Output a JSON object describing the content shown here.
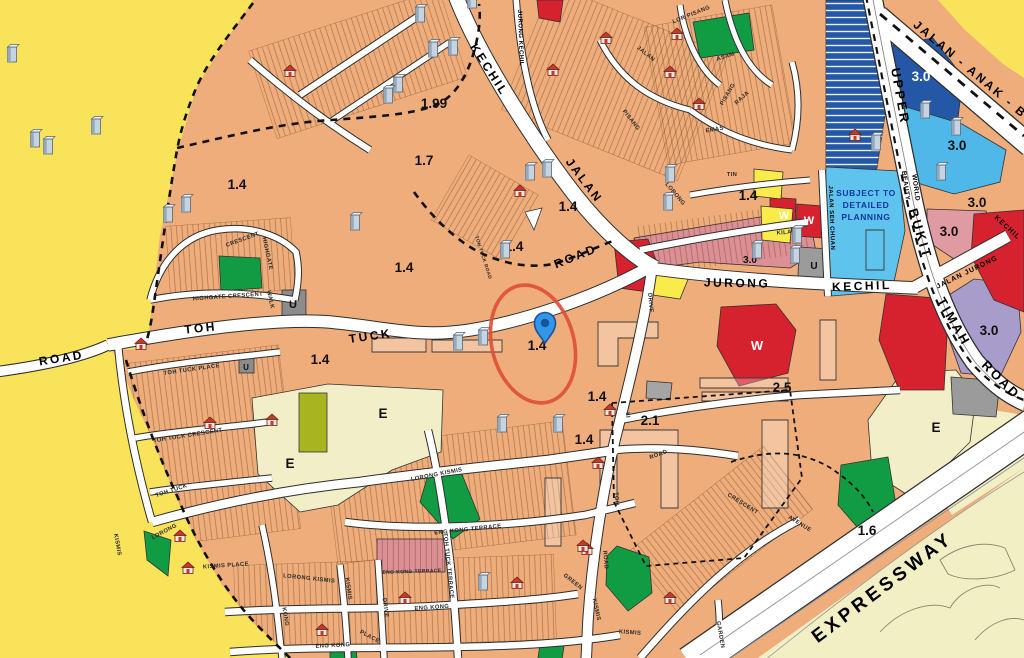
{
  "map": {
    "title": "Master Plan zoning map - Toh Tuck / Jalan Jurong Kechil area",
    "colors": {
      "outside_yellow": "#F8E35A",
      "residential_tan": "#EFAD7B",
      "road_white": "#FFFFFF",
      "civic_cream": "#F1EEC8",
      "olive": "#A9B421",
      "park_green": "#119C44",
      "dark_blue": "#2458A6",
      "light_blue": "#4FB8E8",
      "planning_blue": "#5EC4EE",
      "planning_text": "#14339E",
      "purple": "#A89CCA",
      "commercial_red": "#D6212E",
      "pink": "#E09AA2",
      "yellow_zone": "#F9EC4A",
      "gray_zone": "#9B9B9B",
      "pin_blue": "#3596E8",
      "highlight_red": "#E04F35"
    },
    "subject_planning": {
      "lines": [
        "SUBJECT TO",
        "DETAILED",
        "PLANNING"
      ],
      "x": 866,
      "y": 196,
      "lh": 12
    },
    "region_labels": [
      {
        "t": "1.99",
        "x": 434,
        "y": 108
      },
      {
        "t": "1.7",
        "x": 424,
        "y": 165
      },
      {
        "t": "1.4",
        "x": 237,
        "y": 189
      },
      {
        "t": "1.4",
        "x": 404,
        "y": 272
      },
      {
        "t": "1.4",
        "x": 568,
        "y": 211
      },
      {
        "t": "1.4",
        "x": 514,
        "y": 251
      },
      {
        "t": "1.4",
        "x": 748,
        "y": 200
      },
      {
        "t": "1.4",
        "x": 320,
        "y": 364
      },
      {
        "t": "1.4",
        "x": 537,
        "y": 350
      },
      {
        "t": "1.4",
        "x": 597,
        "y": 401
      },
      {
        "t": "1.4",
        "x": 584,
        "y": 444
      },
      {
        "t": "2.1",
        "x": 650,
        "y": 425
      },
      {
        "t": "2.5",
        "x": 782,
        "y": 392
      },
      {
        "t": "1.6",
        "x": 867,
        "y": 535
      },
      {
        "t": "3.0",
        "x": 921,
        "y": 81,
        "c": "#FFFFFF"
      },
      {
        "t": "3.0",
        "x": 957,
        "y": 150
      },
      {
        "t": "3.0",
        "x": 977,
        "y": 207
      },
      {
        "t": "3.0",
        "x": 949,
        "y": 236
      },
      {
        "t": "3.0",
        "x": 989,
        "y": 335
      },
      {
        "t": "3.0",
        "x": 750,
        "y": 263,
        "s": 10
      },
      {
        "t": "W",
        "x": 784,
        "y": 219,
        "c": "#FFFFFF",
        "s": 11
      },
      {
        "t": "W",
        "x": 809,
        "y": 224,
        "c": "#FFFFFF",
        "s": 11
      },
      {
        "t": "W",
        "x": 757,
        "y": 350,
        "c": "#FFFFFF",
        "s": 13
      },
      {
        "t": "E",
        "x": 383,
        "y": 418
      },
      {
        "t": "E",
        "x": 290,
        "y": 468
      },
      {
        "t": "E",
        "x": 936,
        "y": 432
      },
      {
        "t": "U",
        "x": 293,
        "y": 308,
        "s": 11
      },
      {
        "t": "U",
        "x": 814,
        "y": 269,
        "s": 10
      },
      {
        "t": "U",
        "x": 246,
        "y": 370,
        "s": 8
      }
    ],
    "road_labels": [
      {
        "t": "KECHIL",
        "x": 486,
        "y": 72,
        "r": 57
      },
      {
        "t": "JALAN",
        "x": 581,
        "y": 183,
        "r": 53
      },
      {
        "t": "ROAD",
        "x": 577,
        "y": 260,
        "r": -22
      },
      {
        "t": "TOH",
        "x": 201,
        "y": 332,
        "r": -6
      },
      {
        "t": "TUCK",
        "x": 371,
        "y": 340,
        "r": -8
      },
      {
        "t": "ROAD",
        "x": 62,
        "y": 362,
        "r": -9
      },
      {
        "t": "JURONG",
        "x": 737,
        "y": 287,
        "r": 1
      },
      {
        "t": "KECHIL",
        "x": 862,
        "y": 290,
        "r": -2
      },
      {
        "t": "UPPER",
        "x": 896,
        "y": 97,
        "r": 80,
        "s": 13
      },
      {
        "t": "BUKIT",
        "x": 916,
        "y": 235,
        "r": 73,
        "s": 13
      },
      {
        "t": "TIMAH",
        "x": 950,
        "y": 324,
        "r": 60,
        "s": 13
      },
      {
        "t": "ROAD",
        "x": 998,
        "y": 383,
        "r": 45,
        "s": 13
      },
      {
        "t": "JALAN - ANAK - BU",
        "x": 972,
        "y": 76,
        "r": 40,
        "s": 12
      },
      {
        "t": "EXPRESSWAY",
        "x": 886,
        "y": 592,
        "r": -37,
        "s": 19,
        "ls": 4
      },
      {
        "t": "JALAN JURONG",
        "x": 968,
        "y": 274,
        "r": -26,
        "s": 7,
        "ls": 1
      },
      {
        "t": "KECHIL",
        "x": 1006,
        "y": 229,
        "r": 42,
        "s": 7,
        "ls": 1
      },
      {
        "t": "BEAUTY",
        "x": 904,
        "y": 186,
        "r": 82,
        "s": 6.5,
        "ls": 0.5
      },
      {
        "t": "WORLD",
        "x": 914,
        "y": 188,
        "r": 82,
        "s": 6.5,
        "ls": 0.5
      },
      {
        "t": "JURONG KECHIL",
        "x": 519,
        "y": 38,
        "r": 88,
        "s": 6,
        "ls": 0.5
      },
      {
        "t": "JALAN SEH CHUAN",
        "x": 830,
        "y": 218,
        "r": 88,
        "s": 6,
        "ls": 0.5
      }
    ],
    "street_labels": [
      {
        "t": "HIGHGATE  CRESCENT",
        "x": 228,
        "y": 298,
        "r": -4
      },
      {
        "t": "CRESCENT",
        "x": 243,
        "y": 241,
        "r": -20
      },
      {
        "t": "HIGHGATE",
        "x": 266,
        "y": 254,
        "r": 78
      },
      {
        "t": "WALK",
        "x": 269,
        "y": 300,
        "r": 78
      },
      {
        "t": "TOH  TUCK  PLACE",
        "x": 192,
        "y": 371,
        "r": -8
      },
      {
        "t": "TOH  TUCK  CRESCENT",
        "x": 188,
        "y": 437,
        "r": -9
      },
      {
        "t": "TOH  TUCK",
        "x": 172,
        "y": 492,
        "r": -18
      },
      {
        "t": "TOH TUCK ROAD",
        "x": 482,
        "y": 258,
        "r": 72,
        "s": 4.8
      },
      {
        "t": "LORONG  KISMIS",
        "x": 437,
        "y": 476,
        "r": -11
      },
      {
        "t": "KISMIS  PLACE",
        "x": 226,
        "y": 567,
        "r": -4
      },
      {
        "t": "LORONG  KISMIS",
        "x": 309,
        "y": 580,
        "r": 6
      },
      {
        "t": "ENG  KONG  TERRACE",
        "x": 468,
        "y": 531,
        "r": -6
      },
      {
        "t": "ENG KONG TERRACE",
        "x": 412,
        "y": 573,
        "r": -2,
        "s": 5
      },
      {
        "t": "ENG  KONG",
        "x": 432,
        "y": 609,
        "r": -4
      },
      {
        "t": "ENG  KONG",
        "x": 333,
        "y": 647,
        "r": -3
      },
      {
        "t": "PLACE",
        "x": 369,
        "y": 638,
        "r": 28
      },
      {
        "t": "DRIVE",
        "x": 384,
        "y": 608,
        "r": 82
      },
      {
        "t": "KONG",
        "x": 284,
        "y": 617,
        "r": 80
      },
      {
        "t": "KISMIS",
        "x": 347,
        "y": 589,
        "r": 82
      },
      {
        "t": "LORONG",
        "x": 165,
        "y": 533,
        "r": -28
      },
      {
        "t": "KISMIS",
        "x": 116,
        "y": 545,
        "r": 80
      },
      {
        "t": "TOH  TUCK  TERRACE",
        "x": 447,
        "y": 566,
        "r": 84
      },
      {
        "t": "KILAT",
        "x": 786,
        "y": 234,
        "r": -4
      },
      {
        "t": "LORONG",
        "x": 674,
        "y": 195,
        "r": 50
      },
      {
        "t": "TIN",
        "x": 732,
        "y": 176,
        "r": 0
      },
      {
        "t": "EMAS",
        "x": 715,
        "y": 131,
        "r": -10
      },
      {
        "t": "RAJA",
        "x": 743,
        "y": 99,
        "r": -42
      },
      {
        "t": "ASAM",
        "x": 726,
        "y": 58,
        "r": -18
      },
      {
        "t": "LOR  PISANG",
        "x": 692,
        "y": 16,
        "r": -22
      },
      {
        "t": "PISANG",
        "x": 729,
        "y": 95,
        "r": -60
      },
      {
        "t": "PISANG",
        "x": 630,
        "y": 121,
        "r": 52
      },
      {
        "t": "JALAN",
        "x": 645,
        "y": 55,
        "r": 38
      },
      {
        "t": "DRIVE",
        "x": 649,
        "y": 303,
        "r": 85
      },
      {
        "t": "YI",
        "x": 626,
        "y": 415,
        "r": 85
      },
      {
        "t": "TOH",
        "x": 615,
        "y": 499,
        "r": 85
      },
      {
        "t": "ROAD",
        "x": 604,
        "y": 560,
        "r": 85
      },
      {
        "t": "KISMIS",
        "x": 595,
        "y": 610,
        "r": 78
      },
      {
        "t": "KISMIS",
        "x": 630,
        "y": 634,
        "r": 4
      },
      {
        "t": "GREEN",
        "x": 572,
        "y": 583,
        "r": 38
      },
      {
        "t": "GARDEN",
        "x": 719,
        "y": 635,
        "r": 80
      },
      {
        "t": "CRESCENT",
        "x": 742,
        "y": 505,
        "r": 32
      },
      {
        "t": "AVENUE",
        "x": 799,
        "y": 525,
        "r": 32
      },
      {
        "t": "ROAD",
        "x": 659,
        "y": 456,
        "r": -20
      }
    ],
    "markers": {
      "pin": {
        "x": 545,
        "y": 343
      },
      "highlight_ellipse": {
        "cx": 533,
        "cy": 344,
        "rx": 41,
        "ry": 60,
        "rot": -15
      },
      "buildings": [
        [
          12,
          62
        ],
        [
          35,
          147
        ],
        [
          48,
          154
        ],
        [
          96,
          134
        ],
        [
          186,
          212
        ],
        [
          168,
          222
        ],
        [
          355,
          230
        ],
        [
          420,
          22
        ],
        [
          433,
          57
        ],
        [
          453,
          55
        ],
        [
          398,
          92
        ],
        [
          388,
          103
        ],
        [
          472,
          8
        ],
        [
          530,
          180
        ],
        [
          547,
          177
        ],
        [
          505,
          258
        ],
        [
          458,
          350
        ],
        [
          483,
          345
        ],
        [
          502,
          432
        ],
        [
          558,
          432
        ],
        [
          483,
          590
        ],
        [
          670,
          182
        ],
        [
          668,
          210
        ],
        [
          757,
          258
        ],
        [
          797,
          243
        ],
        [
          795,
          263
        ],
        [
          876,
          150
        ],
        [
          925,
          118
        ],
        [
          956,
          135
        ],
        [
          941,
          180
        ]
      ],
      "shophouses": [
        [
          290,
          73
        ],
        [
          606,
          40
        ],
        [
          553,
          72
        ],
        [
          677,
          36
        ],
        [
          670,
          74
        ],
        [
          699,
          106
        ],
        [
          520,
          193
        ],
        [
          855,
          137
        ],
        [
          141,
          346
        ],
        [
          210,
          425
        ],
        [
          272,
          422
        ],
        [
          180,
          538
        ],
        [
          188,
          570
        ],
        [
          405,
          600
        ],
        [
          517,
          585
        ],
        [
          587,
          551
        ],
        [
          598,
          465
        ],
        [
          610,
          412
        ],
        [
          583,
          548
        ],
        [
          670,
          600
        ],
        [
          322,
          632
        ]
      ]
    }
  }
}
